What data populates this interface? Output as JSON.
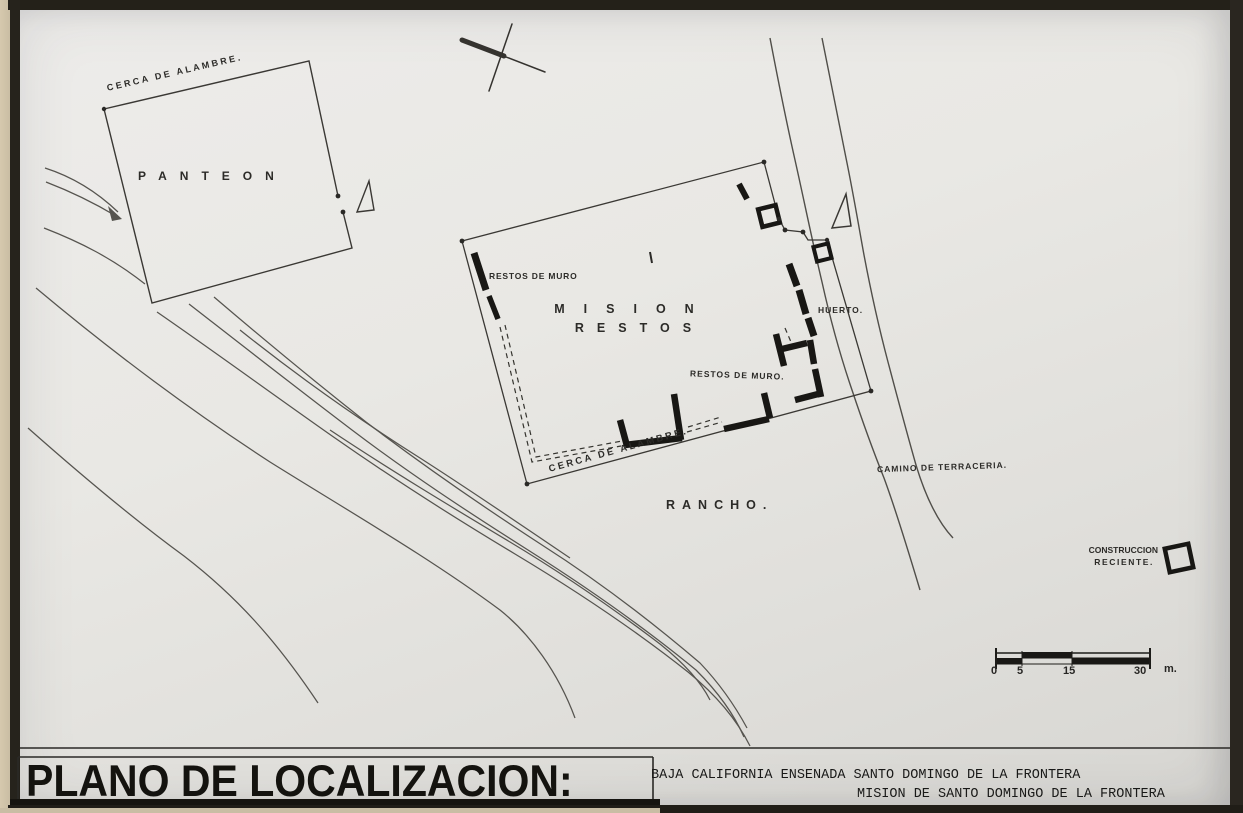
{
  "title_block": {
    "title": "PLANO DE LOCALIZACION:",
    "location_line1": "BAJA CALIFORNIA  ENSENADA  SANTO DOMINGO DE LA FRONTERA",
    "location_line2": "MISION DE SANTO DOMINGO DE LA FRONTERA"
  },
  "map_labels": {
    "panteon": "PANTEON",
    "panteon_fence": "CERCA DE ALAMBRE.",
    "mission_restos_line1": "MISION",
    "mission_restos_line2": "RESTOS",
    "wall_remains_west": "RESTOS DE MURO",
    "wall_remains_south": "RESTOS DE MURO.",
    "huerto": "HUERTO.",
    "mission_fence": "CERCA DE ALAMBRE.",
    "rancho": "RANCHO.",
    "road": "CAMINO DE TERRACERIA."
  },
  "legend": {
    "construction_line1": "CONSTRUCCION",
    "construction_line2": "RECIENTE."
  },
  "scale_bar": {
    "ticks": [
      "0",
      "5",
      "15",
      "30"
    ],
    "unit": "m."
  },
  "colors": {
    "paper": "#e8e7e3",
    "ink": "#1d1c19",
    "thin_line": "#4a4844",
    "frame": "#24221d",
    "page_edge": "#cdc1a8"
  }
}
